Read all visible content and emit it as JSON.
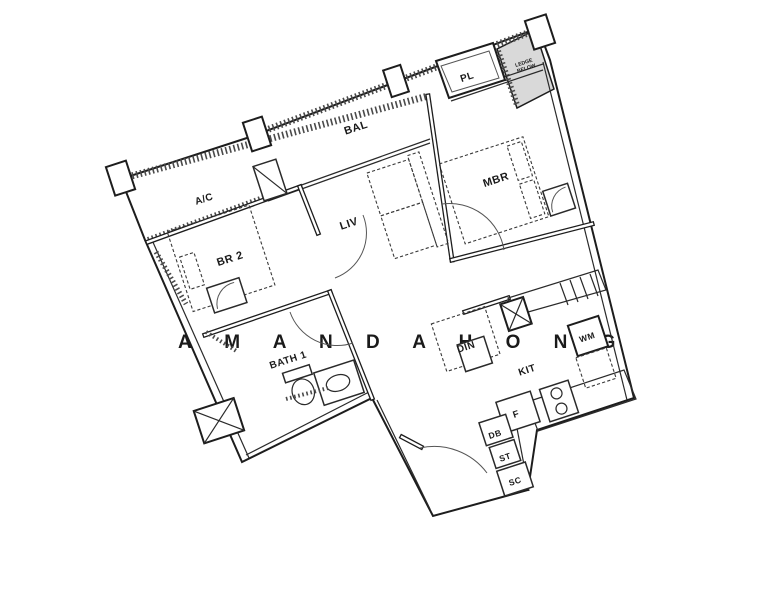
{
  "title": "Apartment floor plan",
  "colors": {
    "wall": "#1d1d1d",
    "ledge_fill": "#d9d9d9",
    "hatch": "#4a4a4a",
    "watermark": "#e3e3e3"
  },
  "labels": {
    "ledge_line1": "LEDGE",
    "ledge_line2": "BELOW",
    "pl": "PL",
    "bal": "BAL",
    "mbr": "MBR",
    "ac": "A/C",
    "br2": "BR 2",
    "liv": "LIV",
    "bath1": "BATH 1",
    "din": "DIN",
    "kit": "KIT",
    "wm": "WM",
    "f": "F",
    "db": "DB",
    "st": "ST",
    "sc": "SC"
  },
  "watermark": "A M A N D A   H O N G",
  "features": [
    "balcony-parapet-hatch",
    "ac-ledge",
    "planter-box",
    "ledge-below-area",
    "master-bed",
    "bedside-table",
    "sofa",
    "bedroom2-bed",
    "wardrobe",
    "dining-table",
    "dining-chair",
    "kitchen-sink",
    "dish-rack",
    "washing-machine",
    "appliance-space",
    "stove-burners",
    "fridge",
    "distribution-board",
    "storage",
    "shoe-cabinet",
    "toilet",
    "wash-basin",
    "shower-area",
    "mbr-door",
    "br2-door",
    "bath-door",
    "entrance-door"
  ]
}
